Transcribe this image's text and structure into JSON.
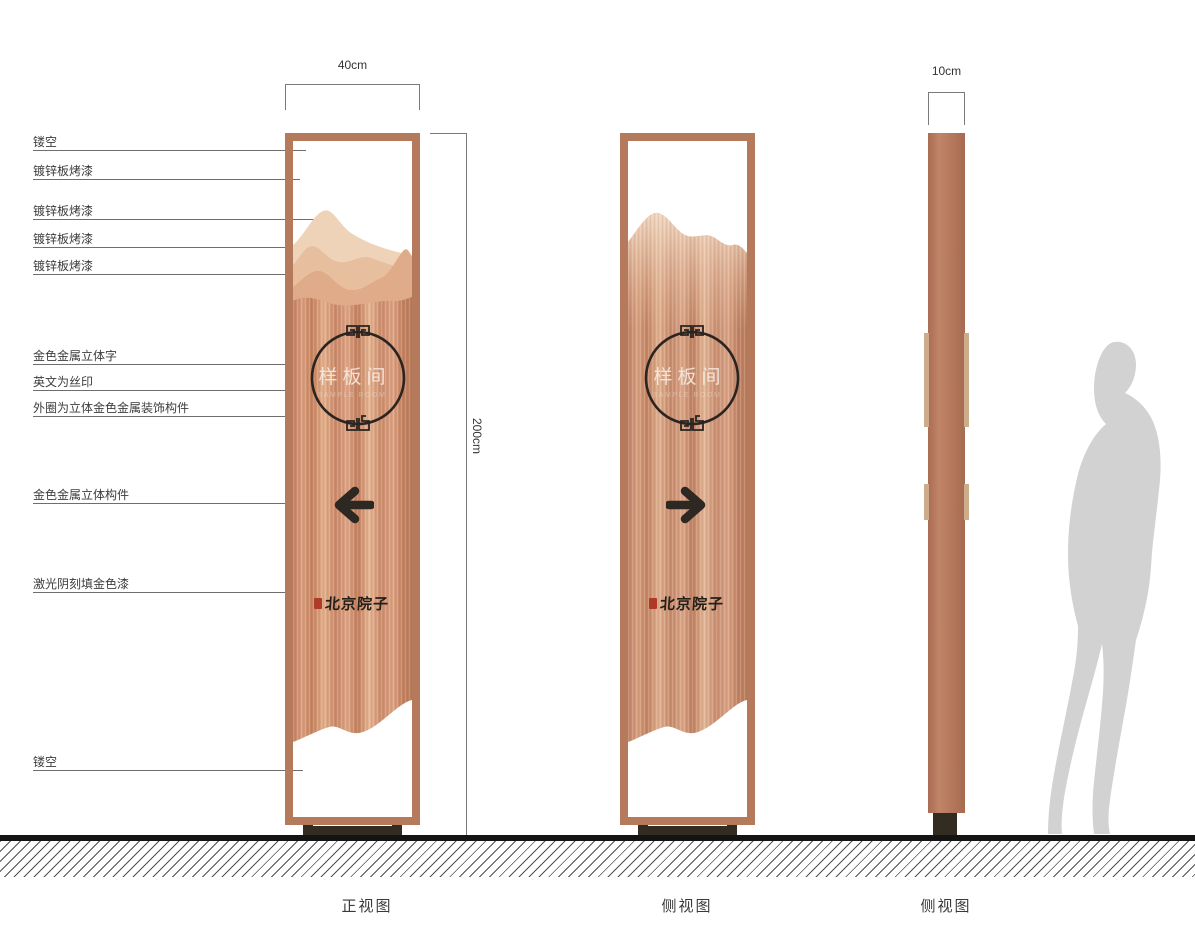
{
  "annotations": [
    {
      "label": "镂空"
    },
    {
      "label": "镀锌板烤漆"
    },
    {
      "label": "镀锌板烤漆"
    },
    {
      "label": "镀锌板烤漆"
    },
    {
      "label": "镀锌板烤漆"
    },
    {
      "label": "金色金属立体字"
    },
    {
      "label": "英文为丝印"
    },
    {
      "label": "外圈为立体金色金属装饰构件"
    },
    {
      "label": "金色金属立体构件"
    },
    {
      "label": "激光阴刻填金色漆"
    },
    {
      "label": "镂空"
    }
  ],
  "dimensions": {
    "front_width": "40cm",
    "total_height": "200cm",
    "side_width": "10cm"
  },
  "sign_front": {
    "plaque_text": "样板间",
    "english_subtitle": "SAMPLE ROOM",
    "brand_text": "北京院子",
    "arrow_direction": "left"
  },
  "sign_back": {
    "plaque_text": "样板间",
    "english_subtitle": "SAMPLE ROOM",
    "brand_text": "北京院子",
    "arrow_direction": "right"
  },
  "captions": {
    "view1": "正视图",
    "view2": "侧视图",
    "view3": "侧视图"
  },
  "icons": {
    "front_arrow": "left-arrow-icon",
    "back_arrow": "right-arrow-icon",
    "circle_ornament": "fret-ornament-ring",
    "seal": "red-seal-stamp"
  },
  "colors": {
    "frame_copper": "#b5795c",
    "panel_copper_light": "#e5b493",
    "panel_copper_dark": "#c1805f",
    "mountain_light": "#efd3b8",
    "ink": "#2d2621",
    "seal_red": "#b03a2a",
    "base_dark": "#332c20",
    "silhouette_gray": "#d2d2d2"
  }
}
